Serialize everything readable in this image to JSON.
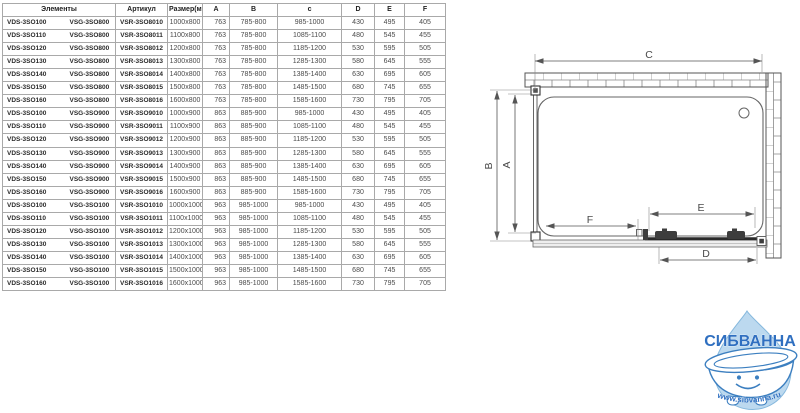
{
  "table": {
    "headers": {
      "elements": "Элементы",
      "article": "Артикул",
      "size": "Размер(мм)",
      "a": "A",
      "b": "B",
      "c": "c",
      "d": "D",
      "e": "E",
      "f": "F"
    },
    "rows": [
      [
        "VDS-3SO100",
        "VSG-3SO800",
        "VSR-3SO8010",
        "1000x800",
        "763",
        "785-800",
        "985-1000",
        "430",
        "495",
        "405"
      ],
      [
        "VDS-3SO110",
        "VSG-3SO800",
        "VSR-3SO8011",
        "1100x800",
        "763",
        "785-800",
        "1085-1100",
        "480",
        "545",
        "455"
      ],
      [
        "VDS-3SO120",
        "VSG-3SO800",
        "VSR-3SO8012",
        "1200x800",
        "763",
        "785-800",
        "1185-1200",
        "530",
        "595",
        "505"
      ],
      [
        "VDS-3SO130",
        "VSG-3SO800",
        "VSR-3SO8013",
        "1300x800",
        "763",
        "785-800",
        "1285-1300",
        "580",
        "645",
        "555"
      ],
      [
        "VDS-3SO140",
        "VSG-3SO800",
        "VSR-3SO8014",
        "1400x800",
        "763",
        "785-800",
        "1385-1400",
        "630",
        "695",
        "605"
      ],
      [
        "VDS-3SO150",
        "VSG-3SO800",
        "VSR-3SO8015",
        "1500x800",
        "763",
        "785-800",
        "1485-1500",
        "680",
        "745",
        "655"
      ],
      [
        "VDS-3SO160",
        "VSG-3SO800",
        "VSR-3SO8016",
        "1600x800",
        "763",
        "785-800",
        "1585-1600",
        "730",
        "795",
        "705"
      ],
      [
        "VDS-3SO100",
        "VSG-3SO900",
        "VSR-3SO9010",
        "1000x900",
        "863",
        "885-900",
        "985-1000",
        "430",
        "495",
        "405"
      ],
      [
        "VDS-3SO110",
        "VSG-3SO900",
        "VSR-3SO9011",
        "1100x900",
        "863",
        "885-900",
        "1085-1100",
        "480",
        "545",
        "455"
      ],
      [
        "VDS-3SO120",
        "VSG-3SO900",
        "VSR-3SO9012",
        "1200x900",
        "863",
        "885-900",
        "1185-1200",
        "530",
        "595",
        "505"
      ],
      [
        "VDS-3SO130",
        "VSG-3SO900",
        "VSR-3SO9013",
        "1300x900",
        "863",
        "885-900",
        "1285-1300",
        "580",
        "645",
        "555"
      ],
      [
        "VDS-3SO140",
        "VSG-3SO900",
        "VSR-3SO9014",
        "1400x900",
        "863",
        "885-900",
        "1385-1400",
        "630",
        "695",
        "605"
      ],
      [
        "VDS-3SO150",
        "VSG-3SO900",
        "VSR-3SO9015",
        "1500x900",
        "863",
        "885-900",
        "1485-1500",
        "680",
        "745",
        "655"
      ],
      [
        "VDS-3SO160",
        "VSG-3SO900",
        "VSR-3SO9016",
        "1600x900",
        "863",
        "885-900",
        "1585-1600",
        "730",
        "795",
        "705"
      ],
      [
        "VDS-3SO100",
        "VSG-3SO100",
        "VSR-3SO1010",
        "1000x1000",
        "963",
        "985-1000",
        "985-1000",
        "430",
        "495",
        "405"
      ],
      [
        "VDS-3SO110",
        "VSG-3SO100",
        "VSR-3SO1011",
        "1100x1000",
        "963",
        "985-1000",
        "1085-1100",
        "480",
        "545",
        "455"
      ],
      [
        "VDS-3SO120",
        "VSG-3SO100",
        "VSR-3SO1012",
        "1200x1000",
        "963",
        "985-1000",
        "1185-1200",
        "530",
        "595",
        "505"
      ],
      [
        "VDS-3SO130",
        "VSG-3SO100",
        "VSR-3SO1013",
        "1300x1000",
        "963",
        "985-1000",
        "1285-1300",
        "580",
        "645",
        "555"
      ],
      [
        "VDS-3SO140",
        "VSG-3SO100",
        "VSR-3SO1014",
        "1400x1000",
        "963",
        "985-1000",
        "1385-1400",
        "630",
        "695",
        "605"
      ],
      [
        "VDS-3SO150",
        "VSG-3SO100",
        "VSR-3SO1015",
        "1500x1000",
        "963",
        "985-1000",
        "1485-1500",
        "680",
        "745",
        "655"
      ],
      [
        "VDS-3SO160",
        "VSG-3SO100",
        "VSR-3SO1016",
        "1600x1000",
        "963",
        "985-1000",
        "1585-1600",
        "730",
        "795",
        "705"
      ]
    ]
  },
  "diagram": {
    "labels": {
      "c": "C",
      "b": "B",
      "a": "A",
      "f": "F",
      "e": "E",
      "d": "D"
    }
  },
  "logo": {
    "brand": "СИБВАННА",
    "website": "www.sibvanna.ru"
  },
  "colors": {
    "logo_blue": "#2f6fc0",
    "drop_fill": "#bcd9ef",
    "drawing_line": "#555555",
    "table_border": "#a9a9a9"
  }
}
